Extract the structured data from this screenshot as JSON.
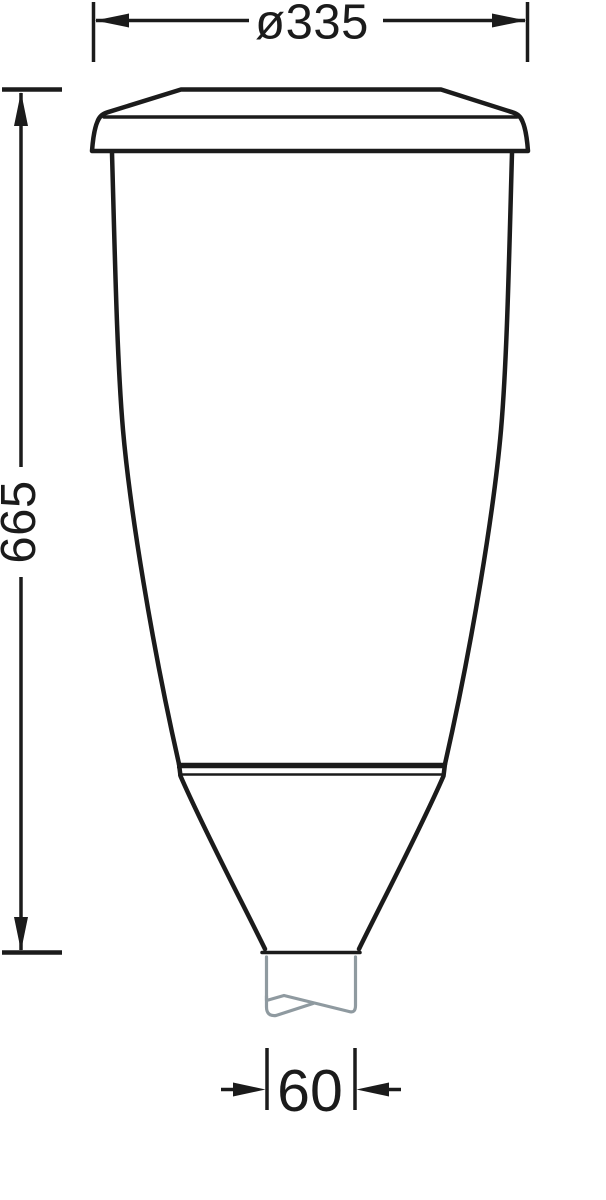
{
  "drawing": {
    "title": "luminaire-dimension-drawing",
    "dimensions": {
      "diameter": {
        "label": "ø335",
        "value": 335
      },
      "height": {
        "label": "665",
        "value": 665
      },
      "spigot_width": {
        "label": "60",
        "value": 60
      }
    },
    "colors": {
      "line": "#1b1b1b",
      "pole": "#8f9aa0",
      "bg": "#ffffff"
    }
  }
}
